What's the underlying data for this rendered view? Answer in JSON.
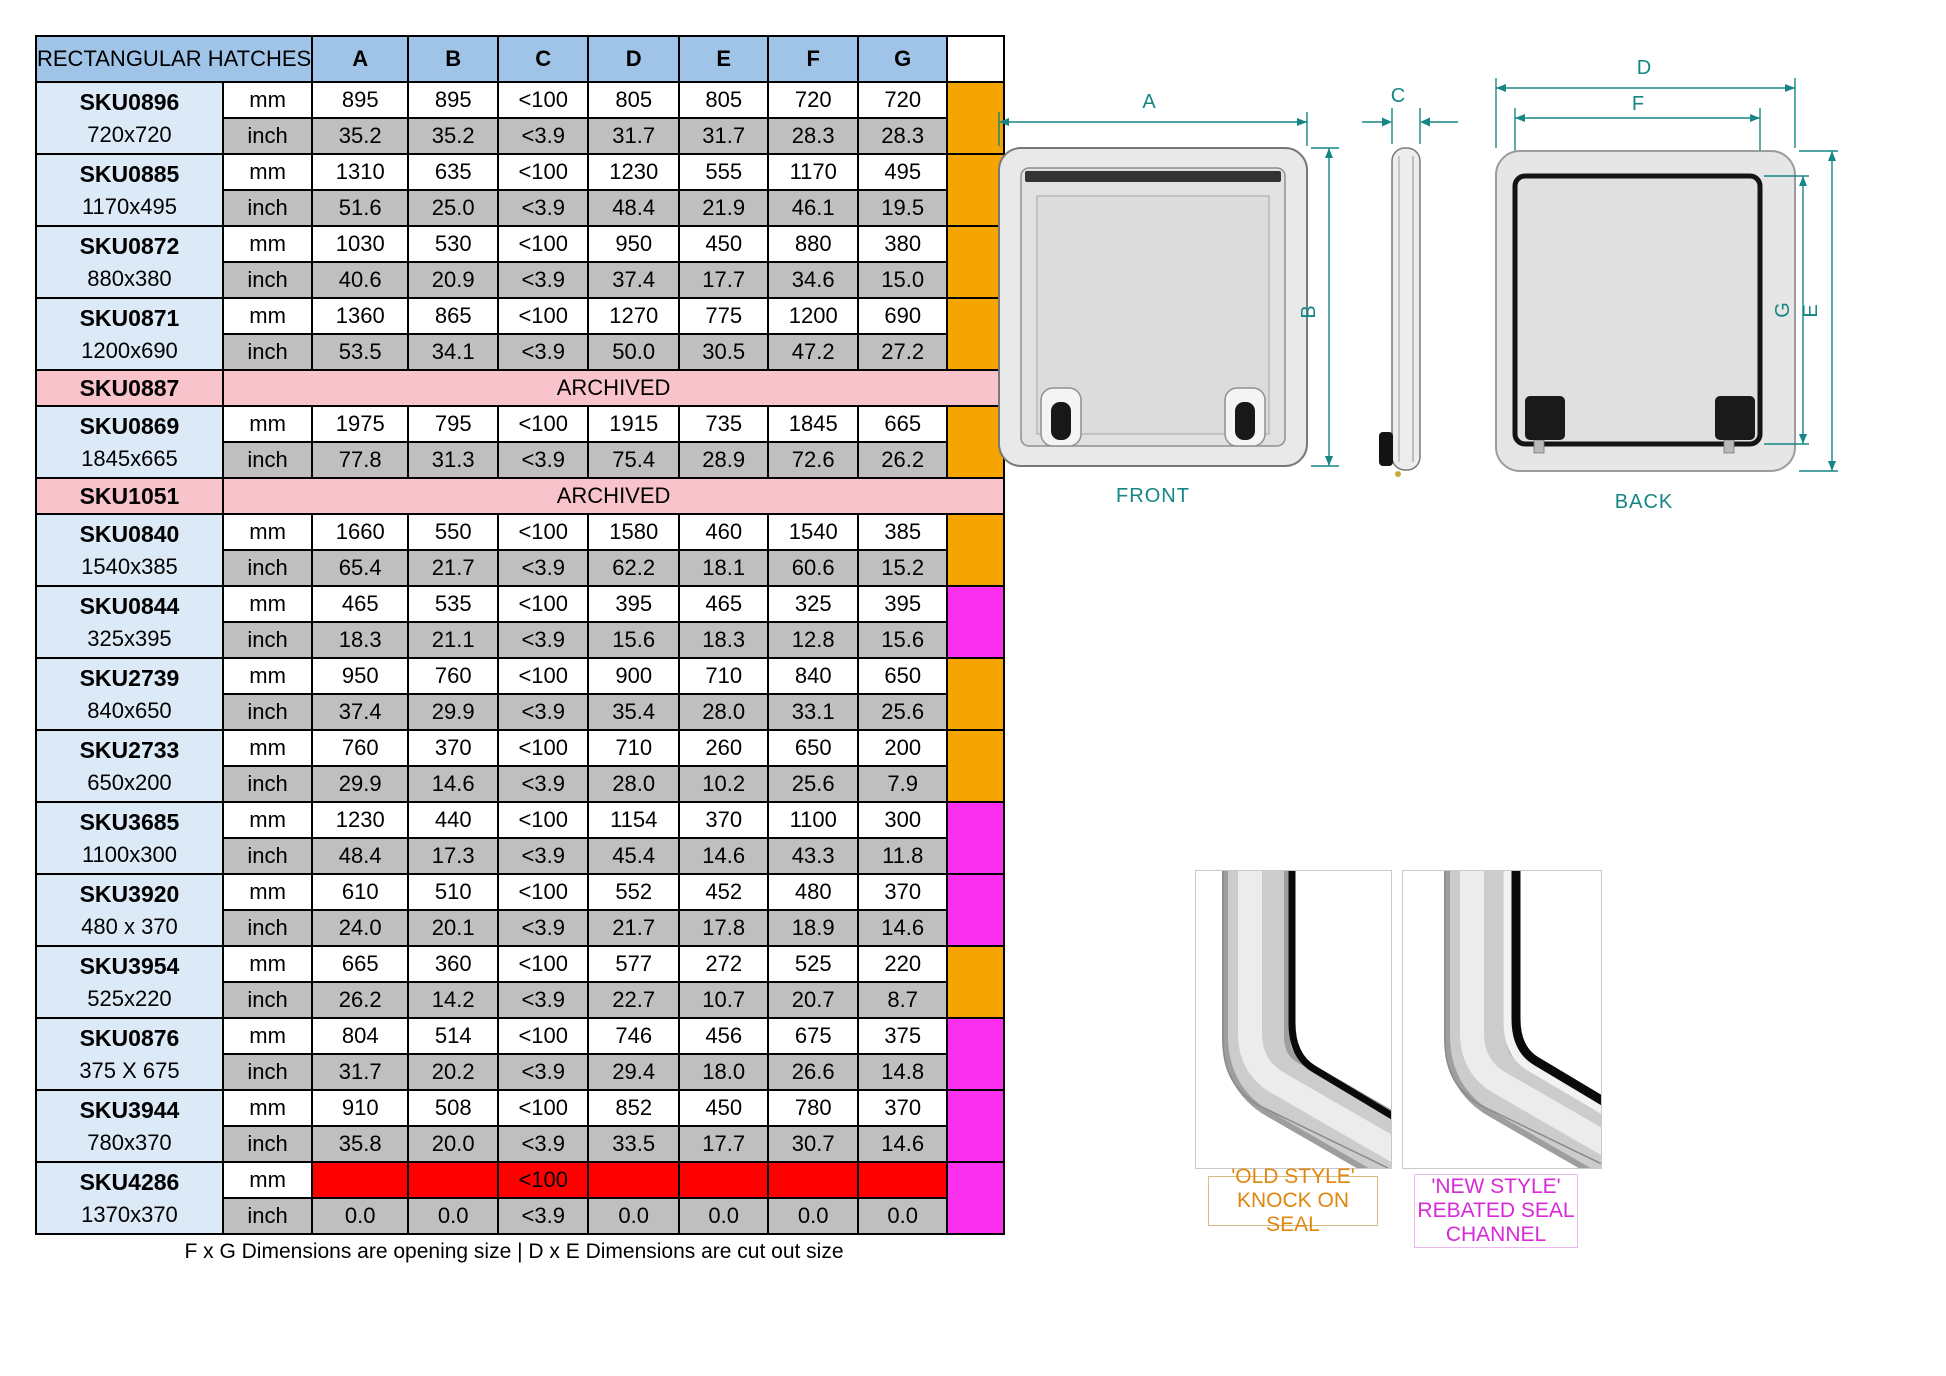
{
  "table": {
    "title": "RECTANGULAR HATCHES",
    "columns": [
      "A",
      "B",
      "C",
      "D",
      "E",
      "F",
      "G"
    ],
    "unit_mm": "mm",
    "unit_inch": "inch",
    "footer": "F x G Dimensions are opening size | D x E Dimensions are cut out size",
    "rows": [
      {
        "sku": "SKU0896",
        "size": "720x720",
        "swatch": "orange",
        "mm": [
          "895",
          "895",
          "<100",
          "805",
          "805",
          "720",
          "720"
        ],
        "inch": [
          "35.2",
          "35.2",
          "<3.9",
          "31.7",
          "31.7",
          "28.3",
          "28.3"
        ]
      },
      {
        "sku": "SKU0885",
        "size": "1170x495",
        "swatch": "orange",
        "mm": [
          "1310",
          "635",
          "<100",
          "1230",
          "555",
          "1170",
          "495"
        ],
        "inch": [
          "51.6",
          "25.0",
          "<3.9",
          "48.4",
          "21.9",
          "46.1",
          "19.5"
        ]
      },
      {
        "sku": "SKU0872",
        "size": "880x380",
        "swatch": "orange",
        "mm": [
          "1030",
          "530",
          "<100",
          "950",
          "450",
          "880",
          "380"
        ],
        "inch": [
          "40.6",
          "20.9",
          "<3.9",
          "37.4",
          "17.7",
          "34.6",
          "15.0"
        ]
      },
      {
        "sku": "SKU0871",
        "size": "1200x690",
        "swatch": "orange",
        "mm": [
          "1360",
          "865",
          "<100",
          "1270",
          "775",
          "1200",
          "690"
        ],
        "inch": [
          "53.5",
          "34.1",
          "<3.9",
          "50.0",
          "30.5",
          "47.2",
          "27.2"
        ]
      },
      {
        "sku": "SKU0887",
        "archived": true,
        "archived_label": "ARCHIVED"
      },
      {
        "sku": "SKU0869",
        "size": "1845x665",
        "swatch": "orange",
        "mm": [
          "1975",
          "795",
          "<100",
          "1915",
          "735",
          "1845",
          "665"
        ],
        "inch": [
          "77.8",
          "31.3",
          "<3.9",
          "75.4",
          "28.9",
          "72.6",
          "26.2"
        ]
      },
      {
        "sku": "SKU1051",
        "archived": true,
        "archived_label": "ARCHIVED"
      },
      {
        "sku": "SKU0840",
        "size": "1540x385",
        "swatch": "orange",
        "mm": [
          "1660",
          "550",
          "<100",
          "1580",
          "460",
          "1540",
          "385"
        ],
        "inch": [
          "65.4",
          "21.7",
          "<3.9",
          "62.2",
          "18.1",
          "60.6",
          "15.2"
        ]
      },
      {
        "sku": "SKU0844",
        "size": "325x395",
        "swatch": "magenta",
        "mm": [
          "465",
          "535",
          "<100",
          "395",
          "465",
          "325",
          "395"
        ],
        "inch": [
          "18.3",
          "21.1",
          "<3.9",
          "15.6",
          "18.3",
          "12.8",
          "15.6"
        ]
      },
      {
        "sku": "SKU2739",
        "size": "840x650",
        "swatch": "orange",
        "mm": [
          "950",
          "760",
          "<100",
          "900",
          "710",
          "840",
          "650"
        ],
        "inch": [
          "37.4",
          "29.9",
          "<3.9",
          "35.4",
          "28.0",
          "33.1",
          "25.6"
        ]
      },
      {
        "sku": "SKU2733",
        "size": "650x200",
        "swatch": "orange",
        "mm": [
          "760",
          "370",
          "<100",
          "710",
          "260",
          "650",
          "200"
        ],
        "inch": [
          "29.9",
          "14.6",
          "<3.9",
          "28.0",
          "10.2",
          "25.6",
          "7.9"
        ]
      },
      {
        "sku": "SKU3685",
        "size": "1100x300",
        "swatch": "magenta",
        "mm": [
          "1230",
          "440",
          "<100",
          "1154",
          "370",
          "1100",
          "300"
        ],
        "inch": [
          "48.4",
          "17.3",
          "<3.9",
          "45.4",
          "14.6",
          "43.3",
          "11.8"
        ]
      },
      {
        "sku": "SKU3920",
        "size": "480 x 370",
        "swatch": "magenta",
        "mm": [
          "610",
          "510",
          "<100",
          "552",
          "452",
          "480",
          "370"
        ],
        "inch": [
          "24.0",
          "20.1",
          "<3.9",
          "21.7",
          "17.8",
          "18.9",
          "14.6"
        ]
      },
      {
        "sku": "SKU3954",
        "size": "525x220",
        "swatch": "orange",
        "mm": [
          "665",
          "360",
          "<100",
          "577",
          "272",
          "525",
          "220"
        ],
        "inch": [
          "26.2",
          "14.2",
          "<3.9",
          "22.7",
          "10.7",
          "20.7",
          "8.7"
        ]
      },
      {
        "sku": "SKU0876",
        "size": "375 X 675",
        "swatch": "magenta",
        "mm": [
          "804",
          "514",
          "<100",
          "746",
          "456",
          "675",
          "375"
        ],
        "inch": [
          "31.7",
          "20.2",
          "<3.9",
          "29.4",
          "18.0",
          "26.6",
          "14.8"
        ]
      },
      {
        "sku": "SKU3944",
        "size": "780x370",
        "swatch": "magenta",
        "mm": [
          "910",
          "508",
          "<100",
          "852",
          "450",
          "780",
          "370"
        ],
        "inch": [
          "35.8",
          "20.0",
          "<3.9",
          "33.5",
          "17.7",
          "30.7",
          "14.6"
        ]
      },
      {
        "sku": "SKU4286",
        "size": "1370x370",
        "swatch": "magenta",
        "mm_red": true,
        "mm": [
          "",
          "",
          "<100",
          "",
          "",
          "",
          ""
        ],
        "inch": [
          "0.0",
          "0.0",
          "<3.9",
          "0.0",
          "0.0",
          "0.0",
          "0.0"
        ]
      }
    ]
  },
  "colors": {
    "header_blue": "#9FC4E8",
    "sku_blue": "#DCE9F7",
    "row_gray": "#BFBFBF",
    "archived_pink": "#F9C3CB",
    "orange": "#F5A400",
    "magenta": "#FB30EE",
    "red": "#FF0000",
    "red_cell_text": "#6E0B00",
    "dimension_teal": "#168585",
    "old_style_orange": "#E0860E",
    "new_style_magenta": "#D829D8"
  },
  "drawings": {
    "front_label": "FRONT",
    "back_label": "BACK",
    "dim_labels": {
      "A": "A",
      "B": "B",
      "C": "C",
      "D": "D",
      "E": "E",
      "F": "F",
      "G": "G"
    }
  },
  "details": {
    "old_style": {
      "line1": "'OLD STYLE'",
      "line2": "KNOCK ON SEAL"
    },
    "new_style": {
      "line1": "'NEW STYLE'",
      "line2": "REBATED SEAL",
      "line3": "CHANNEL"
    }
  }
}
